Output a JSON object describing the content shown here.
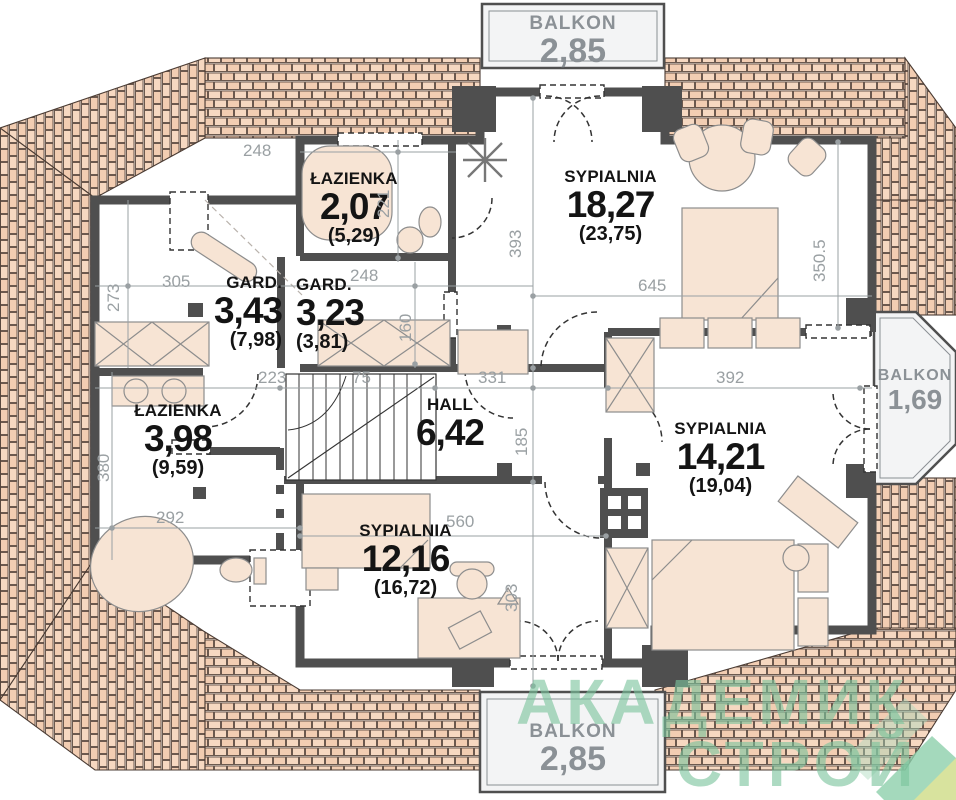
{
  "plan_type": "floor-plan",
  "balconies": {
    "top": {
      "label": "BALKON",
      "area": "2,85"
    },
    "right": {
      "label": "BALKON",
      "area": "1,69"
    },
    "bottom": {
      "label": "BALKON",
      "area": "2,85"
    }
  },
  "rooms": {
    "bath_top": {
      "label": "ŁAZIENKA",
      "area": "2,07",
      "area_gross": "(5,29)"
    },
    "bedroom_top": {
      "label": "SYPIALNIA",
      "area": "18,27",
      "area_gross": "(23,75)"
    },
    "gard_left": {
      "label": "GARD.",
      "area": "3,43",
      "area_gross": "(7,98)"
    },
    "gard_mid": {
      "label": "GARD.",
      "area": "3,23",
      "area_gross": "(3,81)"
    },
    "bath_left": {
      "label": "ŁAZIENKA",
      "area": "3,98",
      "area_gross": "(9,59)"
    },
    "hall": {
      "label": "HALL",
      "area": "6,42"
    },
    "bedroom_right": {
      "label": "SYPIALNIA",
      "area": "14,21",
      "area_gross": "(19,04)"
    },
    "bedroom_bottom": {
      "label": "SYPIALNIA",
      "area": "12,16",
      "area_gross": "(16,72)"
    }
  },
  "dimensions": {
    "top_bath_width": "248",
    "top_bath_depth": "221",
    "bedroom_top_depth": "393",
    "bedroom_top_width": "645",
    "bedroom_top_right_depth": "350.5",
    "gard_left_depth": "273",
    "gard_left_width": "305",
    "gard_mid_width": "248",
    "gard_mid_depth": "160",
    "hall_left_width": "223",
    "stairs_width": "75",
    "hall_width": "331",
    "hall_depth": "185",
    "bedroom_right_width": "392",
    "bath_left_depth": "380",
    "bath_left_width": "292",
    "bedroom_bottom_width": "560",
    "bedroom_bottom_depth": "303"
  },
  "watermark": {
    "line1": "АКАДЕМИК",
    "line2": "СТРОЙ"
  },
  "colors": {
    "roof_tile": "#f6d8c1",
    "roof_tile_dark": "#f2cdb2",
    "wall": "#4f4f4f",
    "dimension_text": "#9aa0a3",
    "room_text": "#141414",
    "balcony_text": "#8b9196",
    "furniture_fill": "#f7e4d4",
    "watermark_green": "#7ac49d"
  }
}
